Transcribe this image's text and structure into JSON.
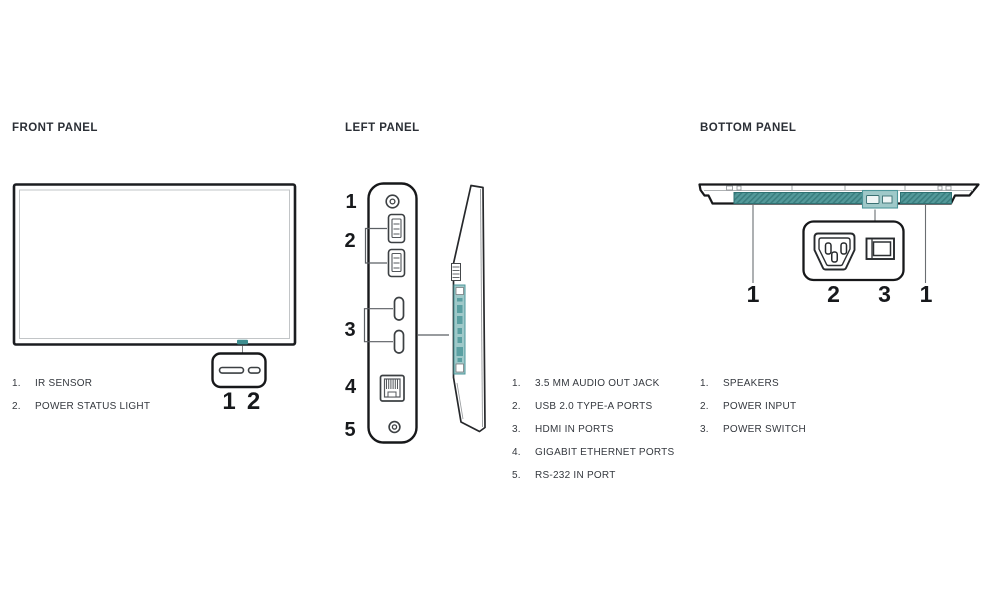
{
  "colors": {
    "heading": "#2b2f36",
    "text": "#34383e",
    "line": "#1b1d20",
    "teal": "#3f8e90",
    "tealLight": "#9fc9c9",
    "speakerTeal": "#4f9798"
  },
  "sections": {
    "front": {
      "title": "FRONT PANEL",
      "callouts": [
        "1",
        "2"
      ],
      "legend": [
        {
          "num": "1.",
          "label": "IR SENSOR"
        },
        {
          "num": "2.",
          "label": "POWER STATUS LIGHT"
        }
      ]
    },
    "left": {
      "title": "LEFT PANEL",
      "callouts": [
        "1",
        "2",
        "3",
        "4",
        "5"
      ],
      "legend": [
        {
          "num": "1.",
          "label": "3.5 MM AUDIO OUT JACK"
        },
        {
          "num": "2.",
          "label": "USB 2.0 TYPE-A PORTS"
        },
        {
          "num": "3.",
          "label": "HDMI IN PORTS"
        },
        {
          "num": "4.",
          "label": "GIGABIT ETHERNET PORTS"
        },
        {
          "num": "5.",
          "label": "RS-232 IN PORT"
        }
      ]
    },
    "bottom": {
      "title": "BOTTOM PANEL",
      "callouts": [
        "1",
        "2",
        "3",
        "1"
      ],
      "legend": [
        {
          "num": "1.",
          "label": "SPEAKERS"
        },
        {
          "num": "2.",
          "label": "POWER INPUT"
        },
        {
          "num": "3.",
          "label": "POWER SWITCH"
        }
      ]
    }
  }
}
